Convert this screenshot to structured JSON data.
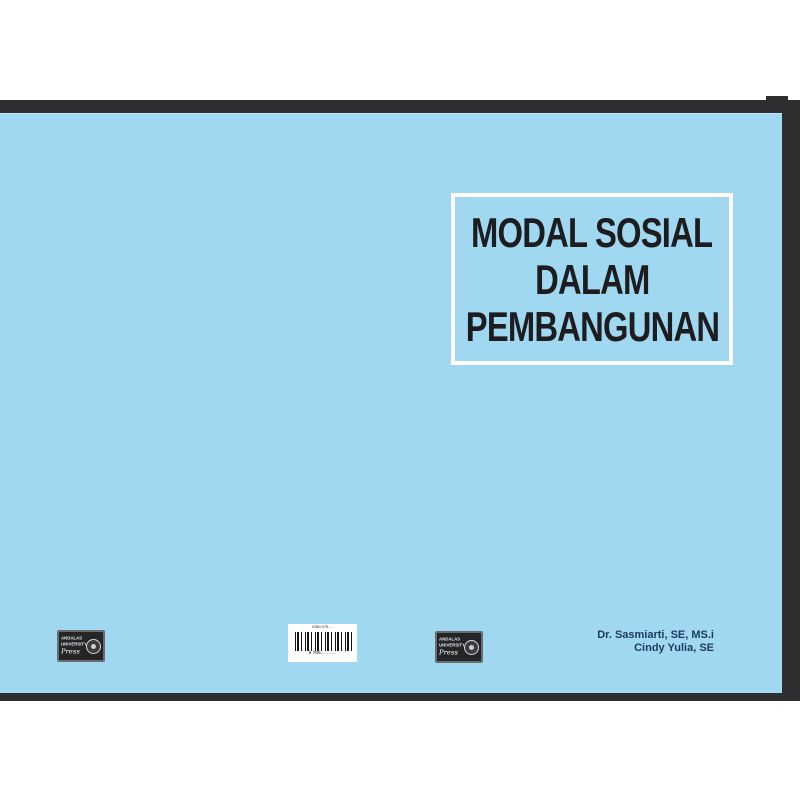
{
  "page": {
    "background": "#ffffff"
  },
  "book_cover": {
    "cover_color": "#a0d8f2",
    "frame_color": "#2f2f31",
    "front": {
      "title_lines": [
        "MODAL SOSIAL",
        "DALAM",
        "PEMBANGUNAN"
      ],
      "title_color": "#1d1d1f",
      "title_box_border_color": "#ffffff",
      "authors": [
        "Dr. Sasmiarti, SE, MS.i",
        "Cindy Yulia, SE"
      ],
      "authors_color": "#1d3a5f"
    },
    "back": {
      "barcode": {
        "top_text": "ISBN 978-…",
        "digits": "9  786…  ……"
      }
    },
    "publisher": {
      "name": "Andalas University Press",
      "line1": "ANDALAS",
      "line2": "UNIVERSITY",
      "script": "Press"
    }
  }
}
